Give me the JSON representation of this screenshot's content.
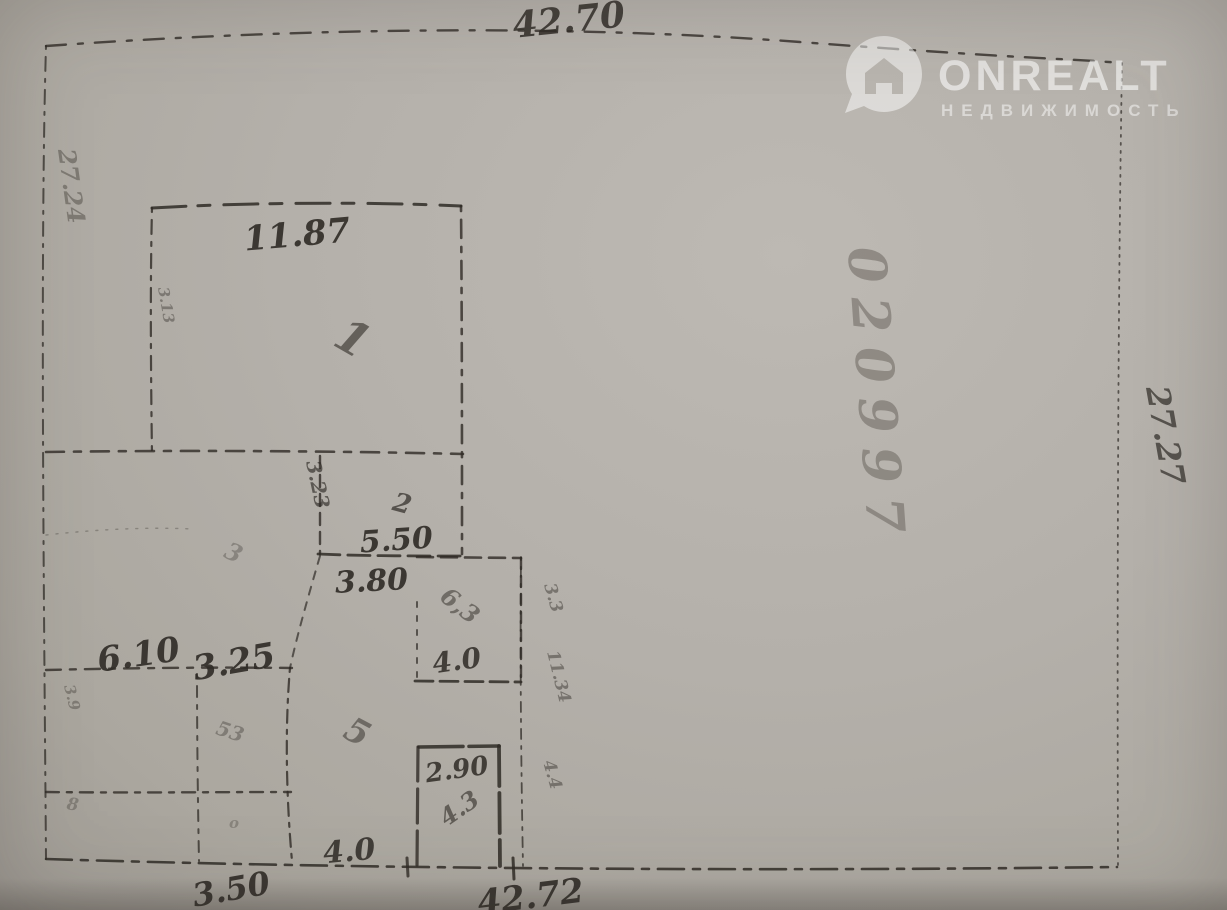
{
  "watermark": {
    "brand": "ONREALT",
    "subtitle": "НЕДВИЖИМОСТЬ",
    "color": "rgba(255,255,255,0.58)"
  },
  "plan": {
    "ink": "#2f2b26",
    "faint_ink": "#4a443d",
    "outer_dimensions": {
      "top": "42.70",
      "right": "27.27",
      "bottom": "42.72",
      "left": "27.24"
    },
    "labels": [
      {
        "name": "dim-top-42-70",
        "text": "42.70",
        "x": 570,
        "y": 32,
        "size": 36,
        "rot": -6,
        "op": 0.85,
        "mid": true
      },
      {
        "name": "dim-room1-11-87",
        "text": "11.87",
        "x": 298,
        "y": 246,
        "size": 34,
        "rot": -5,
        "op": 0.9,
        "mid": true
      },
      {
        "name": "room1-number",
        "text": "1",
        "x": 345,
        "y": 352,
        "size": 46,
        "rot": 30,
        "op": 0.6,
        "mid": true
      },
      {
        "name": "dim-3-23-vertical",
        "text": "3.23",
        "x": 306,
        "y": 462,
        "size": 20,
        "rot": 78,
        "op": 0.65
      },
      {
        "name": "room2-number",
        "text": "2",
        "x": 400,
        "y": 512,
        "size": 26,
        "rot": 15,
        "op": 0.7,
        "mid": true
      },
      {
        "name": "dim-5-50",
        "text": "5.50",
        "x": 397,
        "y": 550,
        "size": 30,
        "rot": -4,
        "op": 0.9,
        "mid": true
      },
      {
        "name": "dim-3-80",
        "text": "3.80",
        "x": 372,
        "y": 591,
        "size": 30,
        "rot": -3,
        "op": 0.9,
        "mid": true
      },
      {
        "name": "dim-6-10",
        "text": "6.10",
        "x": 140,
        "y": 666,
        "size": 34,
        "rot": -8,
        "op": 0.9,
        "mid": true
      },
      {
        "name": "dim-3-25",
        "text": "3.25",
        "x": 236,
        "y": 673,
        "size": 34,
        "rot": -10,
        "op": 0.9,
        "mid": true
      },
      {
        "name": "room3-note",
        "text": "6,3",
        "x": 455,
        "y": 612,
        "size": 24,
        "rot": 38,
        "op": 0.5,
        "mid": true
      },
      {
        "name": "dim-4-0-room3",
        "text": "4.0",
        "x": 458,
        "y": 670,
        "size": 28,
        "rot": -8,
        "op": 0.85,
        "mid": true
      },
      {
        "name": "note-3-3-vertical",
        "text": "3.3",
        "x": 544,
        "y": 585,
        "size": 17,
        "rot": 74,
        "op": 0.45
      },
      {
        "name": "note-11-34-vertical",
        "text": "11.34",
        "x": 547,
        "y": 652,
        "size": 17,
        "rot": 76,
        "op": 0.45
      },
      {
        "name": "note-4-4-vertical",
        "text": "4.4",
        "x": 543,
        "y": 762,
        "size": 17,
        "rot": 74,
        "op": 0.45
      },
      {
        "name": "room5-number",
        "text": "5",
        "x": 352,
        "y": 742,
        "size": 34,
        "rot": 28,
        "op": 0.5,
        "mid": true
      },
      {
        "name": "dim-2-90",
        "text": "2.90",
        "x": 458,
        "y": 778,
        "size": 26,
        "rot": -8,
        "op": 0.85,
        "mid": true
      },
      {
        "name": "wc-note-4-3",
        "text": "4.3",
        "x": 464,
        "y": 815,
        "size": 24,
        "rot": -35,
        "op": 0.6,
        "mid": true
      },
      {
        "name": "dim-4-0-bottom",
        "text": "4.0",
        "x": 350,
        "y": 861,
        "size": 30,
        "rot": -5,
        "op": 0.85,
        "mid": true
      },
      {
        "name": "dim-3-50",
        "text": "3.50",
        "x": 233,
        "y": 900,
        "size": 32,
        "rot": -10,
        "op": 0.9,
        "mid": true
      },
      {
        "name": "dim-bottom-42-72",
        "text": "42.72",
        "x": 532,
        "y": 908,
        "size": 34,
        "rot": -7,
        "op": 0.9,
        "mid": true
      },
      {
        "name": "dim-right-27-27",
        "text": "27.27",
        "x": 1146,
        "y": 388,
        "size": 32,
        "rot": 80,
        "op": 0.7
      },
      {
        "name": "dim-left-27-24",
        "text": "27.24",
        "x": 58,
        "y": 150,
        "size": 24,
        "rot": 82,
        "op": 0.38
      },
      {
        "name": "note-3-13-vertical",
        "text": "3.13",
        "x": 158,
        "y": 288,
        "size": 15,
        "rot": 80,
        "op": 0.4
      },
      {
        "name": "stamp-020997",
        "text": "020997",
        "x": 848,
        "y": 248,
        "size": 52,
        "rot": 86,
        "op": 0.38,
        "ls": 14,
        "c": "#4a443d"
      },
      {
        "name": "note-3-faint",
        "text": "3",
        "x": 230,
        "y": 560,
        "size": 24,
        "rot": 25,
        "op": 0.3,
        "mid": true
      },
      {
        "name": "note-53-faint",
        "text": "53",
        "x": 228,
        "y": 738,
        "size": 20,
        "rot": 18,
        "op": 0.35,
        "mid": true
      },
      {
        "name": "note-3-9-faint",
        "text": "3.9",
        "x": 64,
        "y": 686,
        "size": 15,
        "rot": 76,
        "op": 0.35
      },
      {
        "name": "note-8-faint",
        "text": "8",
        "x": 72,
        "y": 810,
        "size": 17,
        "rot": 8,
        "op": 0.3,
        "mid": true
      },
      {
        "name": "note-o-faint",
        "text": "o",
        "x": 234,
        "y": 828,
        "size": 15,
        "rot": 0,
        "op": 0.28,
        "mid": true
      }
    ],
    "walls": [
      {
        "name": "boundary-top",
        "d": "M46,46 C300,28 560,24 800,42 S1060,58 1122,63",
        "w": 2.4,
        "dash": "20 12 5 12",
        "op": 0.8
      },
      {
        "name": "boundary-left",
        "d": "M46,46 C40,250 44,600 46,859",
        "w": 2,
        "dash": "3 8 14 8",
        "op": 0.75
      },
      {
        "name": "boundary-bottom",
        "d": "M46,859 C400,870 800,871 1117,867",
        "w": 2.6,
        "dash": "26 9 7 9",
        "op": 0.85
      },
      {
        "name": "boundary-right",
        "d": "M1122,63 C1118,300 1117,600 1118,867",
        "w": 1.8,
        "dash": "2 6",
        "op": 0.7
      },
      {
        "name": "room1-top-wall",
        "d": "M152,208 C250,202 380,202 461,206",
        "w": 3,
        "dash": "34 12 12 14",
        "op": 0.85
      },
      {
        "name": "room1-left-wall",
        "d": "M152,208 C150,290 151,380 152,456",
        "w": 2.2,
        "dash": "4 8 14 8",
        "op": 0.8
      },
      {
        "name": "room1-right-wall",
        "d": "M461,206 C462,320 462,450 462,554",
        "w": 2.6,
        "dash": "5 9 18 9",
        "op": 0.8
      },
      {
        "name": "wall-y453",
        "d": "M46,452 C180,450 340,451 463,454",
        "w": 2.6,
        "dash": "18 10 7 10",
        "op": 0.8
      },
      {
        "name": "room2-left-wall",
        "d": "M320,456 L320,554",
        "w": 2.4,
        "dash": "12 7",
        "op": 0.8
      },
      {
        "name": "room2-bottom-wall",
        "d": "M318,554 C360,556 420,556 464,556",
        "w": 2.8,
        "dash": "22 8",
        "op": 0.85
      },
      {
        "name": "room3-top-wall",
        "d": "M417,557 L521,558",
        "w": 2.6,
        "dash": "16 8",
        "op": 0.8
      },
      {
        "name": "room3-right-wall",
        "d": "M521,558 L521,681",
        "w": 2.4,
        "dash": "11 7",
        "op": 0.8
      },
      {
        "name": "room3-bottom-wall",
        "d": "M415,681 L521,682",
        "w": 2.8,
        "dash": "18 7",
        "op": 0.85
      },
      {
        "name": "room3-left-wall",
        "d": "M417,602 L417,682",
        "w": 2,
        "dash": "5 9",
        "op": 0.7
      },
      {
        "name": "inner-right-spine",
        "d": "M521,557 C520,650 521,760 523,866",
        "w": 1.8,
        "dash": "3 7 10 7",
        "op": 0.75
      },
      {
        "name": "wall-y668",
        "d": "M46,670 C130,668 220,667 292,668",
        "w": 2.4,
        "dash": "15 9 6 9",
        "op": 0.8
      },
      {
        "name": "wall-diagonal",
        "d": "M320,556 C306,604 296,640 290,668",
        "w": 2,
        "dash": "8 8",
        "op": 0.7
      },
      {
        "name": "wall-x290",
        "d": "M290,668 C285,725 286,795 292,861",
        "w": 2.2,
        "dash": "4 7 13 7",
        "op": 0.8
      },
      {
        "name": "wall-x197",
        "d": "M197,674 C197,740 198,810 199,861",
        "w": 2,
        "dash": "4 8 11 8",
        "op": 0.75
      },
      {
        "name": "wall-y792",
        "d": "M46,792 C130,793 220,792 291,792",
        "w": 2.4,
        "dash": "13 8 5 8",
        "op": 0.8
      },
      {
        "name": "wc-top-wall",
        "d": "M419,747 L499,746",
        "w": 3.6,
        "dash": "44 6",
        "op": 0.85
      },
      {
        "name": "wc-left-wall",
        "d": "M418,747 L417,866",
        "w": 3.2,
        "dash": "34 8",
        "op": 0.8
      },
      {
        "name": "wc-right-wall",
        "d": "M499,746 L500,866",
        "w": 3.8,
        "dash": "40 7",
        "op": 0.85
      },
      {
        "name": "faint-pencil-line",
        "d": "M46,535 C100,529 150,527 192,529",
        "w": 1.4,
        "dash": "2 8",
        "op": 0.3
      },
      {
        "name": "bottom-tick-1",
        "d": "M407,858 L408,876",
        "w": 3,
        "op": 0.8
      },
      {
        "name": "bottom-tick-2",
        "d": "M513,858 L514,879",
        "w": 3,
        "op": 0.85
      }
    ]
  }
}
